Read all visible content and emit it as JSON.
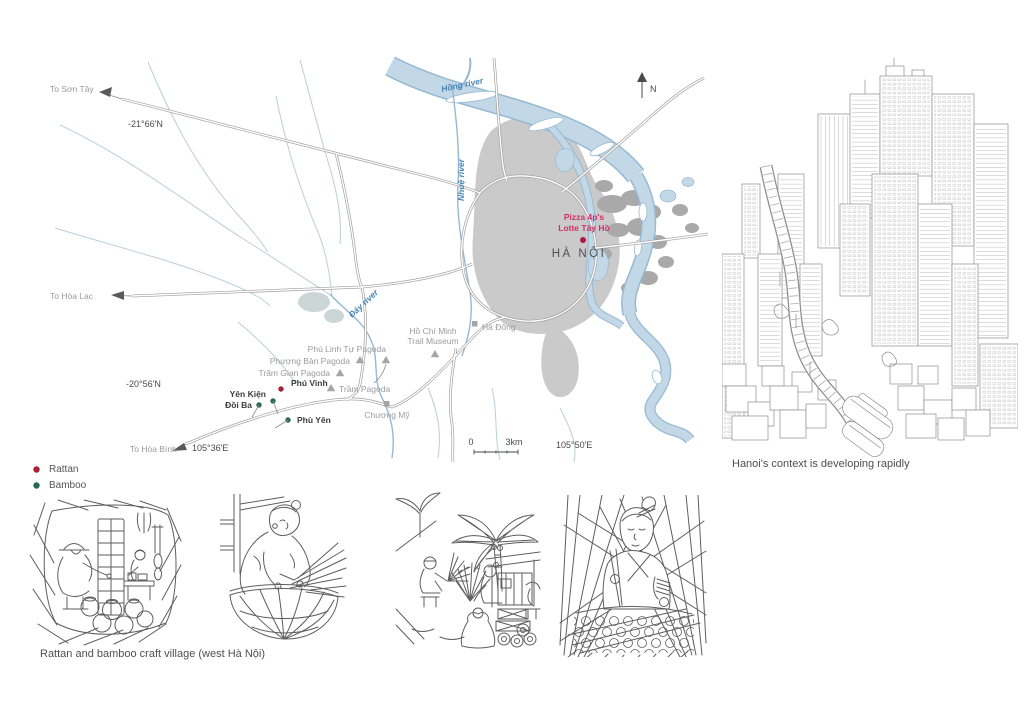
{
  "page": {
    "background": "#ffffff"
  },
  "map": {
    "labels": {
      "to_son_tay": "To Sơn Tây",
      "lat_top": "-21°66'N",
      "hong_river": "Hồng river",
      "north": "N",
      "nhue_river": "Nhuệ river",
      "pizza_line1": "Pizza 4p's",
      "pizza_line2": "Lotte Tây Hồ",
      "hanoi": "HÀ NỘI",
      "to_hoa_lac": "To Hòa Lạc",
      "day_river": "Đáy river",
      "hcm_museum_line1": "Hồ Chí Minh",
      "hcm_museum_line2": "Trail Museum",
      "ha_dong": "Hà Đông",
      "phu_linh_tu_pagoda": "Phú Linh Tự Pagoda",
      "phuong_ban_pagoda": "Phượng Bản Pagoda",
      "tram_gian_pagoda": "Trăm Gian Pagoda",
      "tram_pagoda": "Trầm Pagoda",
      "phu_vinh": "Phú Vinh",
      "yen_kien": "Yên Kiện",
      "doi_ba": "Đồi Ba",
      "phu_yen": "Phù Yên",
      "chuong_my": "Chương Mỹ",
      "lat_bottom": "-20°56'N",
      "to_hoa_binh": "To Hòa Bình",
      "lon_left": "105°36'E",
      "lon_right": "105°50'E",
      "scale_zero": "0",
      "scale_max": "3km"
    },
    "colors": {
      "river_fill": "#c3d8e7",
      "river_edge": "#96b9d2",
      "urban": "#cacaca",
      "urban_dark": "#a9a9a9",
      "road": "#9c9c9c",
      "accent_text": "#d23069",
      "accent_dot": "#b0164f"
    }
  },
  "legend": {
    "items": [
      {
        "label": "Rattan",
        "color": "#a82336"
      },
      {
        "label": "Bamboo",
        "color": "#2a6a52"
      }
    ]
  },
  "city_panel": {
    "caption": "Hanoi's context is developing rapidly"
  },
  "villages_panel": {
    "caption": "Rattan and bamboo craft village (west Hà Nội)"
  }
}
